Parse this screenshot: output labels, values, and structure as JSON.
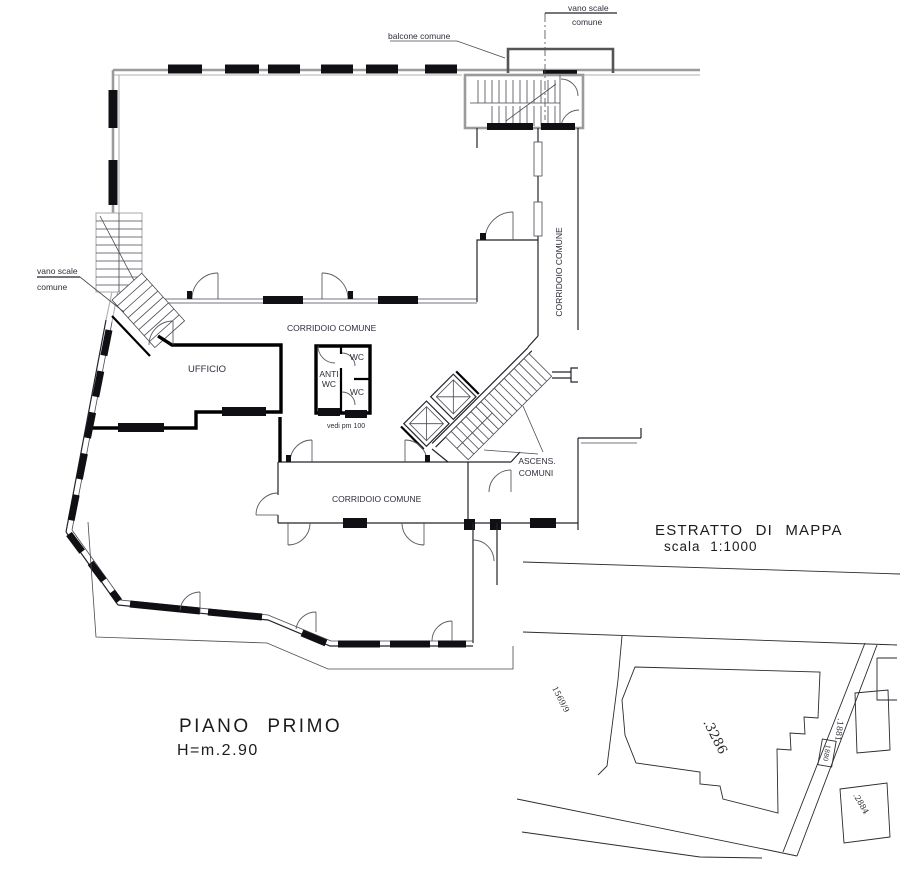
{
  "drawing": {
    "title": "PIANO PRIMO",
    "height_note": "H=m.2.90"
  },
  "plan": {
    "balcony_label": "balcone comune",
    "stairwell_top_label": {
      "line1": "vano scale",
      "line2": "comune"
    },
    "stairwell_left_label": {
      "line1": "vano scale",
      "line2": "comune"
    },
    "hall_corridor_label": "CORRIDOIO COMUNE",
    "right_corridor_label": "CORRIDOIO COMUNE",
    "lower_corridor_label": "CORRIDOIO COMUNE",
    "office_label": "UFFICIO",
    "wc_lobby_label": {
      "line1": "ANTI",
      "line2": "WC"
    },
    "wc_top_label": "WC",
    "wc_bottom_label": "WC",
    "note_label": "vedi pm 100",
    "elevators_label": {
      "line1": "ASCENS.",
      "line2": "COMUNI"
    }
  },
  "map": {
    "title": "ESTRATTO DI MAPPA",
    "scale": "scala 1:1000",
    "parcel_1569": "1569/9",
    "parcel_3286": ".3286",
    "parcel_1881": ".1881",
    "parcel_1880": "1880",
    "parcel_2884": ".2884"
  },
  "colors": {
    "wall_gray": "#9b9b9b",
    "line": "#23232b",
    "thick_wall": "#000000",
    "label_text": "#2e2e3c",
    "title_text": "#1c1c1c"
  }
}
